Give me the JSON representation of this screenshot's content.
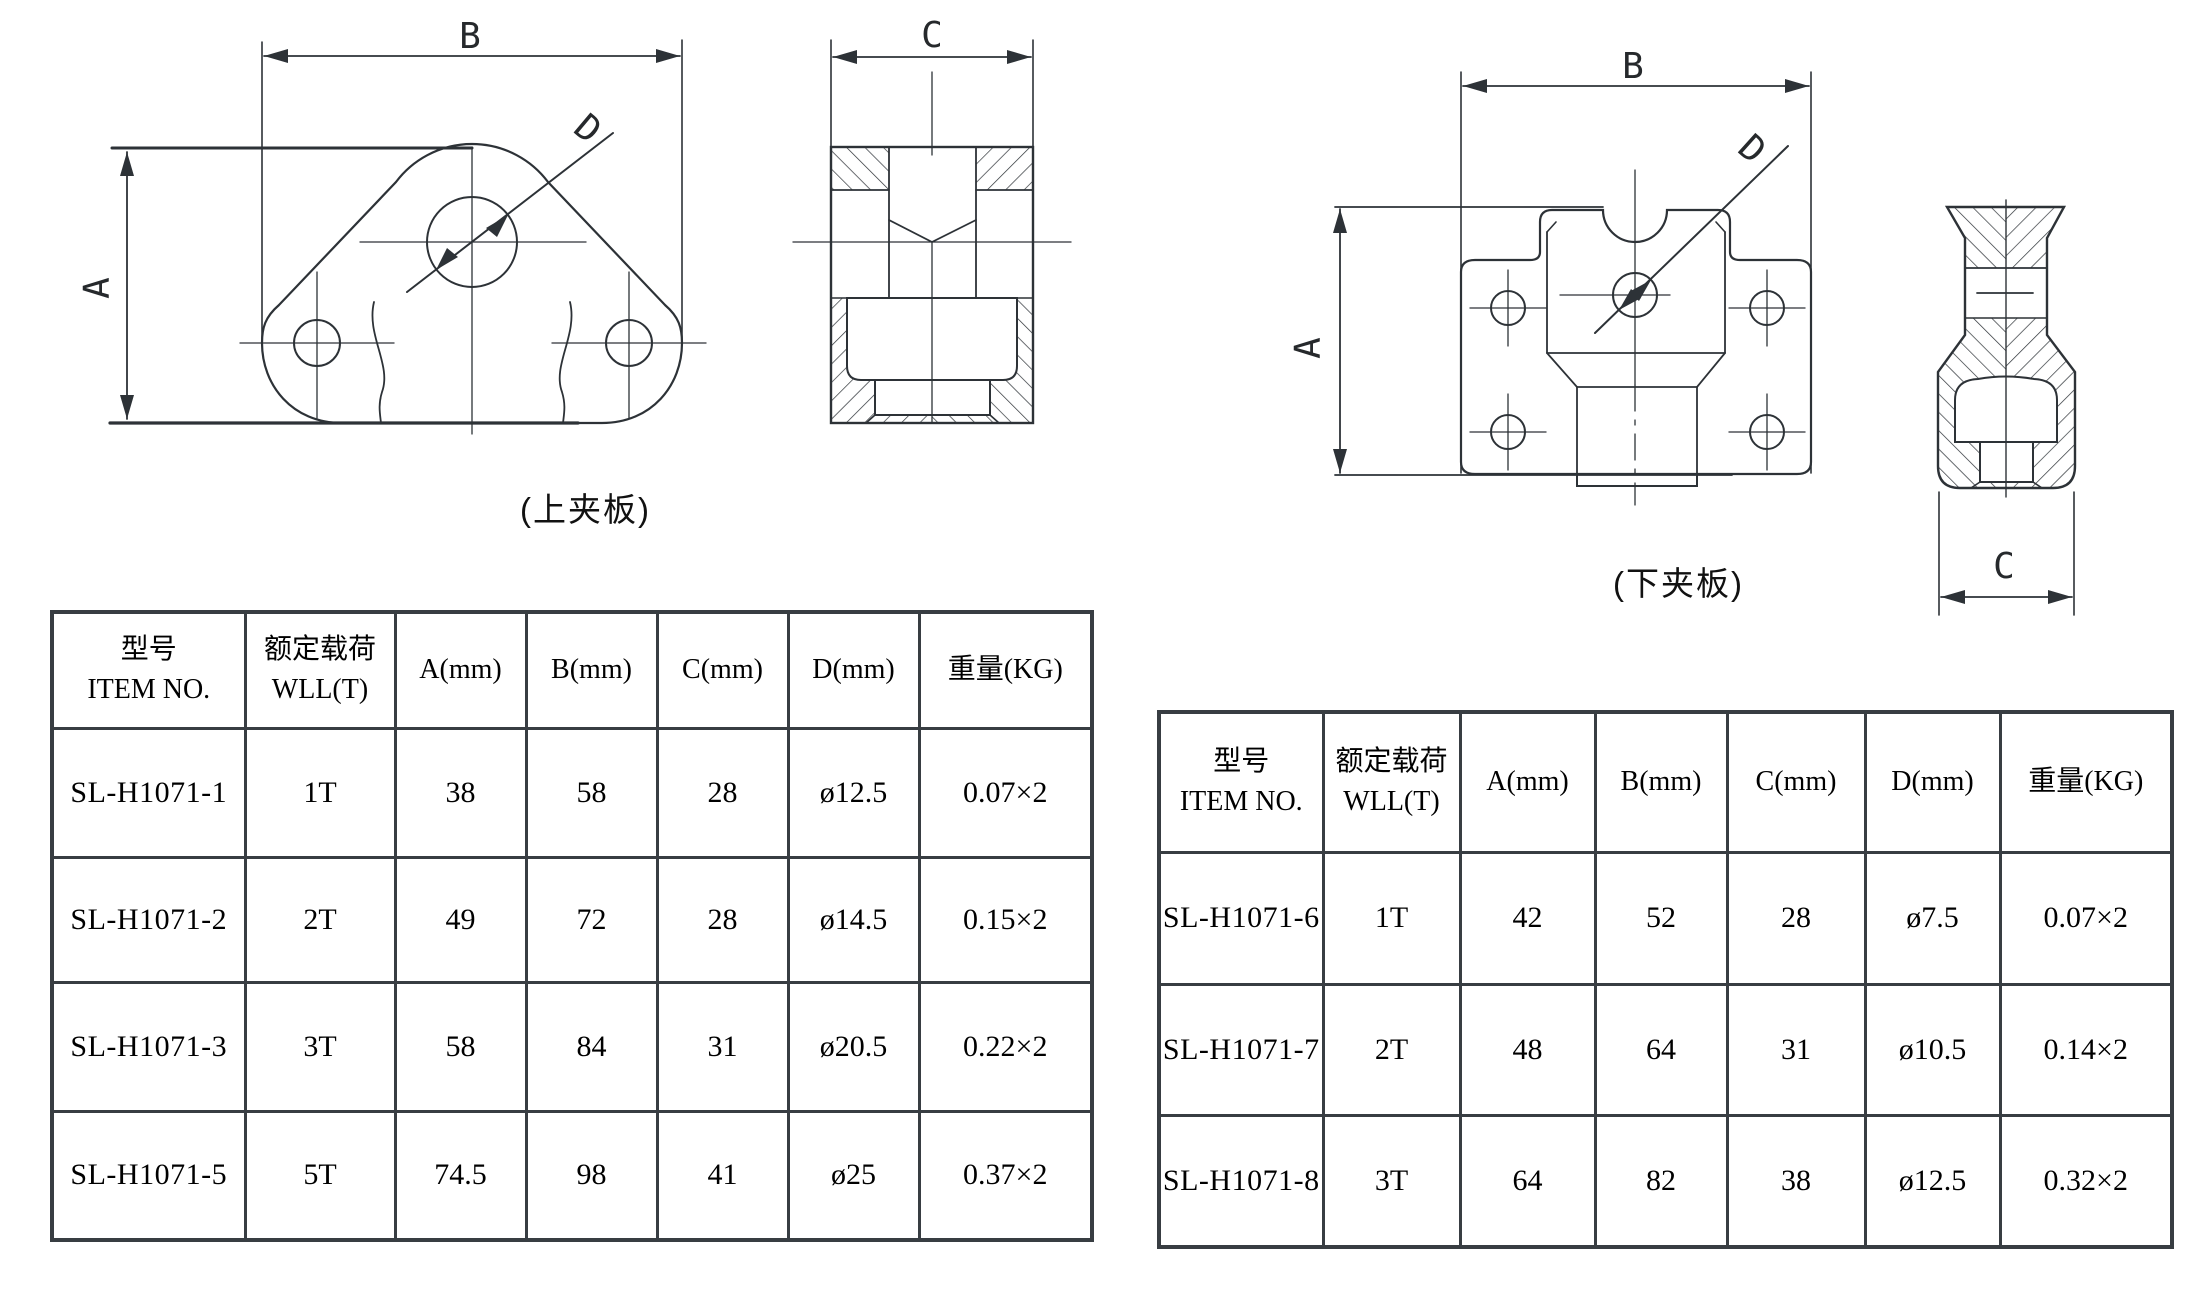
{
  "page": {
    "bg": "#ffffff",
    "line_color": "#2d3237"
  },
  "drawings": {
    "upper_front": {
      "caption": "(上夹板)",
      "dim_a": "A",
      "dim_b": "B",
      "dim_d": "D"
    },
    "upper_section": {
      "dim_c": "C"
    },
    "lower_front": {
      "caption": "(下夹板)",
      "dim_a": "A",
      "dim_b": "B",
      "dim_d": "D"
    },
    "lower_section": {
      "dim_c": "C"
    }
  },
  "left_table": {
    "headers": [
      "型号\nITEM NO.",
      "额定载荷\nWLL(T)",
      "A(mm)",
      "B(mm)",
      "C(mm)",
      "D(mm)",
      "重量(KG)"
    ],
    "rows": [
      [
        "SL-H1071-1",
        "1T",
        "38",
        "58",
        "28",
        "ø12.5",
        "0.07×2"
      ],
      [
        "SL-H1071-2",
        "2T",
        "49",
        "72",
        "28",
        "ø14.5",
        "0.15×2"
      ],
      [
        "SL-H1071-3",
        "3T",
        "58",
        "84",
        "31",
        "ø20.5",
        "0.22×2"
      ],
      [
        "SL-H1071-5",
        "5T",
        "74.5",
        "98",
        "41",
        "ø25",
        "0.37×2"
      ]
    ]
  },
  "right_table": {
    "headers": [
      "型号\nITEM NO.",
      "额定载荷\nWLL(T)",
      "A(mm)",
      "B(mm)",
      "C(mm)",
      "D(mm)",
      "重量(KG)"
    ],
    "rows": [
      [
        "SL-H1071-6",
        "1T",
        "42",
        "52",
        "28",
        "ø7.5",
        "0.07×2"
      ],
      [
        "SL-H1071-7",
        "2T",
        "48",
        "64",
        "31",
        "ø10.5",
        "0.14×2"
      ],
      [
        "SL-H1071-8",
        "3T",
        "64",
        "82",
        "38",
        "ø12.5",
        "0.32×2"
      ]
    ]
  }
}
